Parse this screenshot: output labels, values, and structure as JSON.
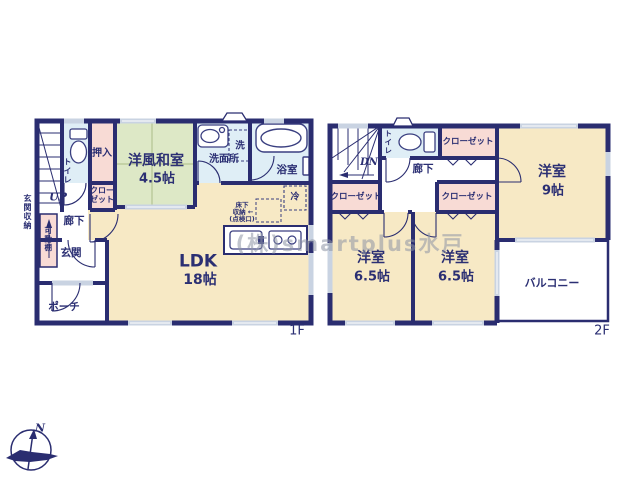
{
  "watermark": "(株)smartplus水戸",
  "compass": {
    "north": "N"
  },
  "colors": {
    "wall_navy": "#2a2d70",
    "room_cream": "#f7e9c5",
    "tatami_green": "#dde8c6",
    "closet_pink": "#f8dbd5",
    "wet_area_blue": "#dfeef6",
    "window_gray": "#c9d3e2",
    "watermark_gray": "#8e95a6"
  },
  "floor1": {
    "floor_label": "1F",
    "labels": {
      "entrance_storage": "玄関収納",
      "movable_shelf": "可動棚",
      "stairs_up": "UP",
      "toilet": "トイレ",
      "oshiire": "押入",
      "japanese_room_name": "洋風和室",
      "japanese_room_size": "4.5帖",
      "closet_line1": "クロー",
      "closet_line2": "ゼット",
      "hallway": "廊下",
      "entrance": "玄関",
      "porch": "ポーチ",
      "washer": "洗",
      "washroom": "洗面所",
      "bathroom": "浴室",
      "refrigerator": "冷",
      "underfloor_line1": "床下",
      "underfloor_line2": "収納 ←",
      "underfloor_line3": "(点検口)",
      "ldk_name": "LDK",
      "ldk_size": "18帖"
    }
  },
  "floor2": {
    "floor_label": "2F",
    "labels": {
      "stairs_down": "DN",
      "toilet": "トイレ",
      "hallway": "廊下",
      "closet_top": "クローゼット",
      "closet_left": "クローゼット",
      "closet_right": "クローゼット",
      "bedroom9_name": "洋室",
      "bedroom9_size": "9帖",
      "bedroom65a_name": "洋室",
      "bedroom65a_size": "6.5帖",
      "bedroom65b_name": "洋室",
      "bedroom65b_size": "6.5帖",
      "balcony": "バルコニー"
    }
  }
}
